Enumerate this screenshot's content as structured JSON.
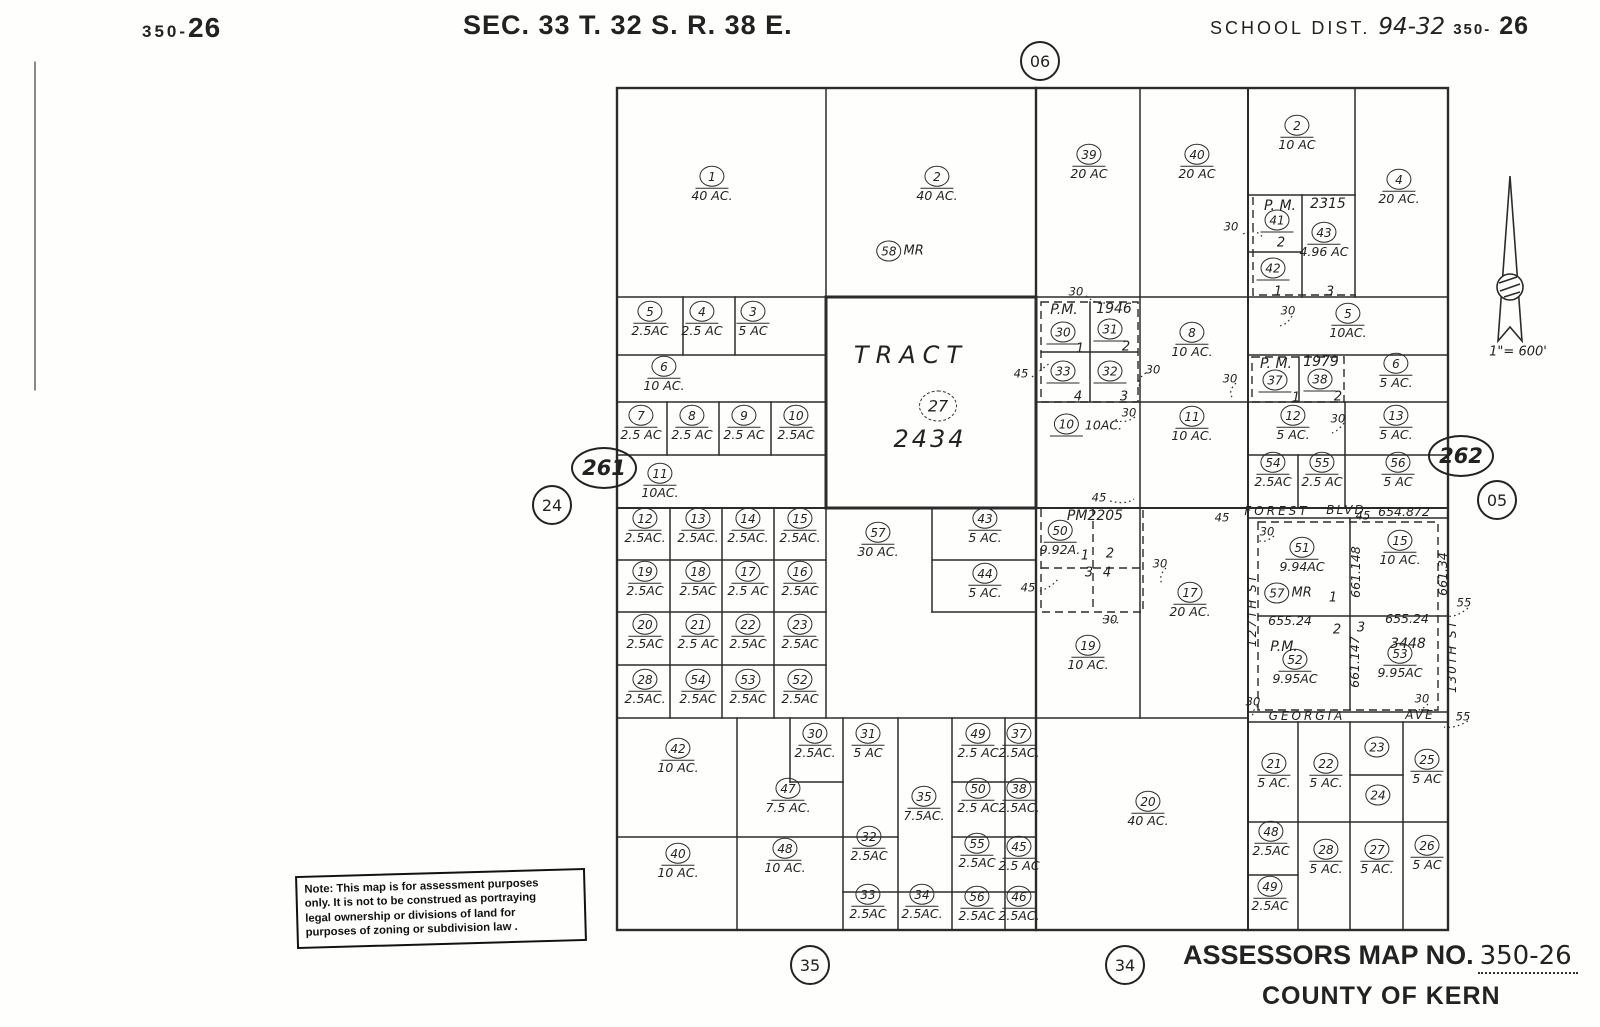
{
  "header": {
    "sheet_prefix": "350-",
    "sheet_number": "26",
    "section_title": "SEC. 33 T. 32 S. R. 38 E.",
    "school_label": "SCHOOL DIST.",
    "school_value": "94-32",
    "school_sheet_prefix": "350-",
    "school_sheet_number": "26"
  },
  "footer": {
    "title_label": "ASSESSORS MAP NO.",
    "map_number": "350-26",
    "county": "COUNTY OF KERN"
  },
  "note": {
    "lines": [
      "Note: This map is for assessment purposes",
      "only. It is not to be construed as portraying",
      "legal ownership or divisions of land for",
      "purposes of zoning or subdivision law ."
    ]
  },
  "scale": "1\"= 600'",
  "map": {
    "parcels": [
      {
        "n": "1",
        "a": "40 AC.",
        "x": 712,
        "y": 184
      },
      {
        "n": "2",
        "a": "40 AC.",
        "x": 937,
        "y": 184
      },
      {
        "n": "58",
        "s": "MR",
        "u": false,
        "i": true,
        "x": 900,
        "y": 251
      },
      {
        "n": "39",
        "a": "20 AC",
        "x": 1089,
        "y": 162
      },
      {
        "n": "40",
        "a": "20 AC",
        "x": 1197,
        "y": 162
      },
      {
        "n": "2",
        "a": "10 AC",
        "x": 1297,
        "y": 133
      },
      {
        "n": "41",
        "x": 1277,
        "y": 221
      },
      {
        "n": "42",
        "x": 1273,
        "y": 269
      },
      {
        "n": "43",
        "a": "4.96 AC",
        "x": 1324,
        "y": 240
      },
      {
        "n": "4",
        "a": "20 AC.",
        "x": 1399,
        "y": 187
      },
      {
        "n": "5",
        "a": "2.5AC",
        "x": 650,
        "y": 319
      },
      {
        "n": "4",
        "a": "2.5 AC",
        "x": 702,
        "y": 319
      },
      {
        "n": "3",
        "a": "5 AC",
        "x": 753,
        "y": 319
      },
      {
        "n": "6",
        "a": "10 AC.",
        "x": 664,
        "y": 374
      },
      {
        "n": "7",
        "a": "2.5 AC",
        "x": 641,
        "y": 423
      },
      {
        "n": "8",
        "a": "2.5 AC",
        "x": 692,
        "y": 423
      },
      {
        "n": "9",
        "a": "2.5 AC",
        "x": 744,
        "y": 423
      },
      {
        "n": "10",
        "a": "2.5AC",
        "x": 796,
        "y": 423
      },
      {
        "n": "11",
        "a": "10AC.",
        "x": 660,
        "y": 481
      },
      {
        "n": "27",
        "d": true,
        "u": false,
        "big": true,
        "x": 938,
        "y": 406
      },
      {
        "n": "30",
        "x": 1063,
        "y": 333
      },
      {
        "n": "31",
        "x": 1110,
        "y": 330
      },
      {
        "n": "33",
        "x": 1063,
        "y": 372
      },
      {
        "n": "32",
        "x": 1110,
        "y": 372
      },
      {
        "n": "8",
        "a": "10 AC.",
        "x": 1192,
        "y": 340
      },
      {
        "n": "5",
        "a": "10AC.",
        "x": 1348,
        "y": 321
      },
      {
        "n": "37",
        "x": 1275,
        "y": 381
      },
      {
        "n": "38",
        "x": 1320,
        "y": 380
      },
      {
        "n": "6",
        "a": "5 AC.",
        "x": 1396,
        "y": 371
      },
      {
        "n": "10",
        "a": "10AC.",
        "i": true,
        "x": 1086,
        "y": 425
      },
      {
        "n": "11",
        "a": "10 AC.",
        "x": 1192,
        "y": 424
      },
      {
        "n": "12",
        "a": "5 AC.",
        "x": 1293,
        "y": 423
      },
      {
        "n": "13",
        "a": "5 AC.",
        "x": 1396,
        "y": 423
      },
      {
        "n": "54",
        "a": "2.5AC",
        "x": 1273,
        "y": 470
      },
      {
        "n": "55",
        "a": "2.5 AC",
        "x": 1322,
        "y": 470
      },
      {
        "n": "56",
        "a": "5 AC",
        "x": 1398,
        "y": 470
      },
      {
        "n": "12",
        "a": "2.5AC.",
        "x": 645,
        "y": 526
      },
      {
        "n": "13",
        "a": "2.5AC.",
        "x": 698,
        "y": 526
      },
      {
        "n": "14",
        "a": "2.5AC.",
        "x": 748,
        "y": 526
      },
      {
        "n": "15",
        "a": "2.5AC.",
        "x": 800,
        "y": 526
      },
      {
        "n": "19",
        "a": "2.5AC",
        "x": 645,
        "y": 579
      },
      {
        "n": "18",
        "a": "2.5AC",
        "x": 698,
        "y": 579
      },
      {
        "n": "17",
        "a": "2.5 AC",
        "x": 748,
        "y": 579
      },
      {
        "n": "16",
        "a": "2.5AC",
        "x": 800,
        "y": 579
      },
      {
        "n": "20",
        "a": "2.5AC",
        "x": 645,
        "y": 632
      },
      {
        "n": "21",
        "a": "2.5 AC",
        "x": 698,
        "y": 632
      },
      {
        "n": "22",
        "a": "2.5AC",
        "x": 748,
        "y": 632
      },
      {
        "n": "23",
        "a": "2.5AC",
        "x": 800,
        "y": 632
      },
      {
        "n": "28",
        "a": "2.5AC.",
        "x": 645,
        "y": 687
      },
      {
        "n": "54",
        "a": "2.5AC",
        "x": 698,
        "y": 687
      },
      {
        "n": "53",
        "a": "2.5AC",
        "x": 748,
        "y": 687
      },
      {
        "n": "52",
        "a": "2.5AC",
        "x": 800,
        "y": 687
      },
      {
        "n": "57",
        "a": "30 AC.",
        "x": 878,
        "y": 540
      },
      {
        "n": "43",
        "a": "5 AC.",
        "x": 985,
        "y": 526
      },
      {
        "n": "44",
        "a": "5 AC.",
        "x": 985,
        "y": 581
      },
      {
        "n": "50",
        "a": "9.92A.",
        "x": 1060,
        "y": 538
      },
      {
        "n": "17",
        "a": "20 AC.",
        "x": 1190,
        "y": 600
      },
      {
        "n": "19",
        "a": "10 AC.",
        "x": 1088,
        "y": 653
      },
      {
        "n": "51",
        "a": "9.94AC",
        "x": 1302,
        "y": 555
      },
      {
        "n": "57",
        "s": "MR",
        "u": false,
        "i": true,
        "x": 1288,
        "y": 593
      },
      {
        "n": "15",
        "a": "10 AC.",
        "x": 1400,
        "y": 548
      },
      {
        "n": "52",
        "a": "9.95AC",
        "x": 1295,
        "y": 667
      },
      {
        "n": "53",
        "a": "9.95AC",
        "x": 1400,
        "y": 661
      },
      {
        "n": "42",
        "a": "10 AC.",
        "x": 678,
        "y": 756
      },
      {
        "n": "30",
        "a": "2.5AC.",
        "x": 815,
        "y": 741
      },
      {
        "n": "31",
        "a": "5 AC",
        "x": 868,
        "y": 741
      },
      {
        "n": "47",
        "a": "7.5 AC.",
        "x": 788,
        "y": 796
      },
      {
        "n": "40",
        "a": "10 AC.",
        "x": 678,
        "y": 861
      },
      {
        "n": "48",
        "a": "10 AC.",
        "x": 785,
        "y": 856
      },
      {
        "n": "32",
        "a": "2.5AC",
        "x": 869,
        "y": 844
      },
      {
        "n": "33",
        "a": "2.5AC",
        "x": 868,
        "y": 902
      },
      {
        "n": "34",
        "a": "2.5AC.",
        "x": 922,
        "y": 902
      },
      {
        "n": "35",
        "a": "7.5AC.",
        "x": 924,
        "y": 804
      },
      {
        "n": "49",
        "a": "2.5 AC",
        "x": 978,
        "y": 741
      },
      {
        "n": "37",
        "a": "2.5AC.",
        "x": 1019,
        "y": 741
      },
      {
        "n": "50",
        "a": "2.5 AC",
        "x": 978,
        "y": 796
      },
      {
        "n": "38",
        "a": "2.5AC.",
        "x": 1019,
        "y": 796
      },
      {
        "n": "55",
        "a": "2.5AC",
        "x": 977,
        "y": 851
      },
      {
        "n": "45",
        "a": "2.5 AC",
        "x": 1019,
        "y": 854
      },
      {
        "n": "56",
        "a": "2.5AC",
        "x": 977,
        "y": 904
      },
      {
        "n": "46",
        "a": "2.5AC.",
        "x": 1019,
        "y": 904
      },
      {
        "n": "20",
        "a": "40 AC.",
        "x": 1148,
        "y": 809
      },
      {
        "n": "21",
        "a": "5 AC.",
        "x": 1274,
        "y": 771
      },
      {
        "n": "22",
        "a": "5 AC.",
        "x": 1326,
        "y": 771
      },
      {
        "n": "23",
        "u": false,
        "x": 1377,
        "y": 747
      },
      {
        "n": "24",
        "u": false,
        "x": 1378,
        "y": 795
      },
      {
        "n": "25",
        "a": "5 AC",
        "x": 1427,
        "y": 767
      },
      {
        "n": "48",
        "a": "2.5AC",
        "x": 1271,
        "y": 839
      },
      {
        "n": "28",
        "a": "5 AC.",
        "x": 1326,
        "y": 857
      },
      {
        "n": "27",
        "a": "5 AC.",
        "x": 1377,
        "y": 857
      },
      {
        "n": "26",
        "a": "5 AC",
        "x": 1427,
        "y": 853
      },
      {
        "n": "49",
        "a": "2.5AC",
        "x": 1270,
        "y": 894
      }
    ],
    "texts": [
      {
        "t": "TRACT",
        "x": 911,
        "y": 355,
        "cls": "tract",
        "ls": 7
      },
      {
        "t": "2434",
        "x": 930,
        "y": 439,
        "cls": "tract",
        "ls": 3
      },
      {
        "t": "P. M.",
        "x": 1280,
        "y": 206,
        "cls": "pm"
      },
      {
        "t": "2315",
        "x": 1328,
        "y": 204,
        "cls": "pm"
      },
      {
        "t": "P.M.",
        "x": 1064,
        "y": 310,
        "cls": "pm"
      },
      {
        "t": "1946",
        "x": 1114,
        "y": 309,
        "cls": "pm"
      },
      {
        "t": "P. M.",
        "x": 1276,
        "y": 364,
        "cls": "pm"
      },
      {
        "t": "1979",
        "x": 1321,
        "y": 362,
        "cls": "pm"
      },
      {
        "t": "PM2205",
        "x": 1095,
        "y": 516,
        "cls": "pm"
      },
      {
        "t": "P.M.",
        "x": 1284,
        "y": 647,
        "cls": "pm"
      },
      {
        "t": "3448",
        "x": 1408,
        "y": 644,
        "cls": "pm"
      },
      {
        "t": "2",
        "x": 1281,
        "y": 243,
        "cls": "lot"
      },
      {
        "t": "1",
        "x": 1278,
        "y": 292,
        "cls": "lot"
      },
      {
        "t": "3",
        "x": 1330,
        "y": 292,
        "cls": "lot"
      },
      {
        "t": "1",
        "x": 1080,
        "y": 349,
        "cls": "lot"
      },
      {
        "t": "2",
        "x": 1126,
        "y": 347,
        "cls": "lot"
      },
      {
        "t": "4",
        "x": 1078,
        "y": 397,
        "cls": "lot"
      },
      {
        "t": "3",
        "x": 1124,
        "y": 397,
        "cls": "lot"
      },
      {
        "t": "1",
        "x": 1296,
        "y": 398,
        "cls": "lot"
      },
      {
        "t": "2",
        "x": 1338,
        "y": 397,
        "cls": "lot"
      },
      {
        "t": "1",
        "x": 1085,
        "y": 556,
        "cls": "lot"
      },
      {
        "t": "2",
        "x": 1110,
        "y": 554,
        "cls": "lot"
      },
      {
        "t": "3",
        "x": 1089,
        "y": 573,
        "cls": "lot"
      },
      {
        "t": "4",
        "x": 1107,
        "y": 573,
        "cls": "lot"
      },
      {
        "t": "1",
        "x": 1333,
        "y": 598,
        "cls": "lot"
      },
      {
        "t": "2",
        "x": 1337,
        "y": 630,
        "cls": "lot"
      },
      {
        "t": "3",
        "x": 1361,
        "y": 628,
        "cls": "lot"
      },
      {
        "t": "654.872",
        "x": 1404,
        "y": 512,
        "cls": "len"
      },
      {
        "t": "655.24",
        "x": 1290,
        "y": 621,
        "cls": "len"
      },
      {
        "t": "655.24",
        "x": 1407,
        "y": 619,
        "cls": "len"
      },
      {
        "t": "661.148",
        "x": 1356,
        "y": 572,
        "cls": "len",
        "rot": true
      },
      {
        "t": "661.34",
        "x": 1443,
        "y": 574,
        "cls": "len",
        "rot": true
      },
      {
        "t": "661.147",
        "x": 1355,
        "y": 662,
        "cls": "len",
        "rot": true
      },
      {
        "t": "30",
        "x": 1231,
        "y": 227,
        "cls": "dim"
      },
      {
        "t": "30",
        "x": 1076,
        "y": 292,
        "cls": "dim"
      },
      {
        "t": "30",
        "x": 1288,
        "y": 311,
        "cls": "dim"
      },
      {
        "t": "45",
        "x": 1021,
        "y": 374,
        "cls": "dim"
      },
      {
        "t": "30",
        "x": 1153,
        "y": 370,
        "cls": "dim"
      },
      {
        "t": "30",
        "x": 1230,
        "y": 379,
        "cls": "dim"
      },
      {
        "t": "30",
        "x": 1129,
        "y": 413,
        "cls": "dim"
      },
      {
        "t": "30",
        "x": 1338,
        "y": 419,
        "cls": "dim"
      },
      {
        "t": "45",
        "x": 1099,
        "y": 498,
        "cls": "dim"
      },
      {
        "t": "45",
        "x": 1222,
        "y": 518,
        "cls": "dim"
      },
      {
        "t": "45",
        "x": 1363,
        "y": 516,
        "cls": "dim"
      },
      {
        "t": "30",
        "x": 1160,
        "y": 564,
        "cls": "dim"
      },
      {
        "t": "45",
        "x": 1028,
        "y": 588,
        "cls": "dim"
      },
      {
        "t": "30",
        "x": 1110,
        "y": 620,
        "cls": "dim"
      },
      {
        "t": "30",
        "x": 1267,
        "y": 532,
        "cls": "dim"
      },
      {
        "t": "55",
        "x": 1464,
        "y": 603,
        "cls": "dim"
      },
      {
        "t": "30",
        "x": 1253,
        "y": 702,
        "cls": "dim"
      },
      {
        "t": "30",
        "x": 1422,
        "y": 699,
        "cls": "dim"
      },
      {
        "t": "55",
        "x": 1463,
        "y": 717,
        "cls": "dim"
      },
      {
        "t": "FOREST",
        "x": 1277,
        "y": 511,
        "cls": "street",
        "ls": 3
      },
      {
        "t": "BLVD",
        "x": 1346,
        "y": 510,
        "cls": "street",
        "ls": 2
      },
      {
        "t": "GEORGIA",
        "x": 1307,
        "y": 716,
        "cls": "street",
        "ls": 3
      },
      {
        "t": "AVE",
        "x": 1420,
        "y": 715,
        "cls": "street",
        "ls": 2
      },
      {
        "t": "127TH ST",
        "x": 1252,
        "y": 610,
        "cls": "street",
        "rot": true,
        "ls": 2
      },
      {
        "t": "130TH ST",
        "x": 1452,
        "y": 656,
        "cls": "street",
        "rot": true,
        "ls": 2
      }
    ],
    "refs": [
      {
        "t": "06",
        "x": 1040,
        "y": 61
      },
      {
        "t": "24",
        "x": 552,
        "y": 505
      },
      {
        "t": "35",
        "x": 810,
        "y": 965
      },
      {
        "t": "34",
        "x": 1125,
        "y": 965
      },
      {
        "t": "05",
        "x": 1497,
        "y": 500
      },
      {
        "t": "261",
        "x": 604,
        "y": 468,
        "oval": true
      },
      {
        "t": "262",
        "x": 1461,
        "y": 456,
        "oval": true
      }
    ]
  }
}
